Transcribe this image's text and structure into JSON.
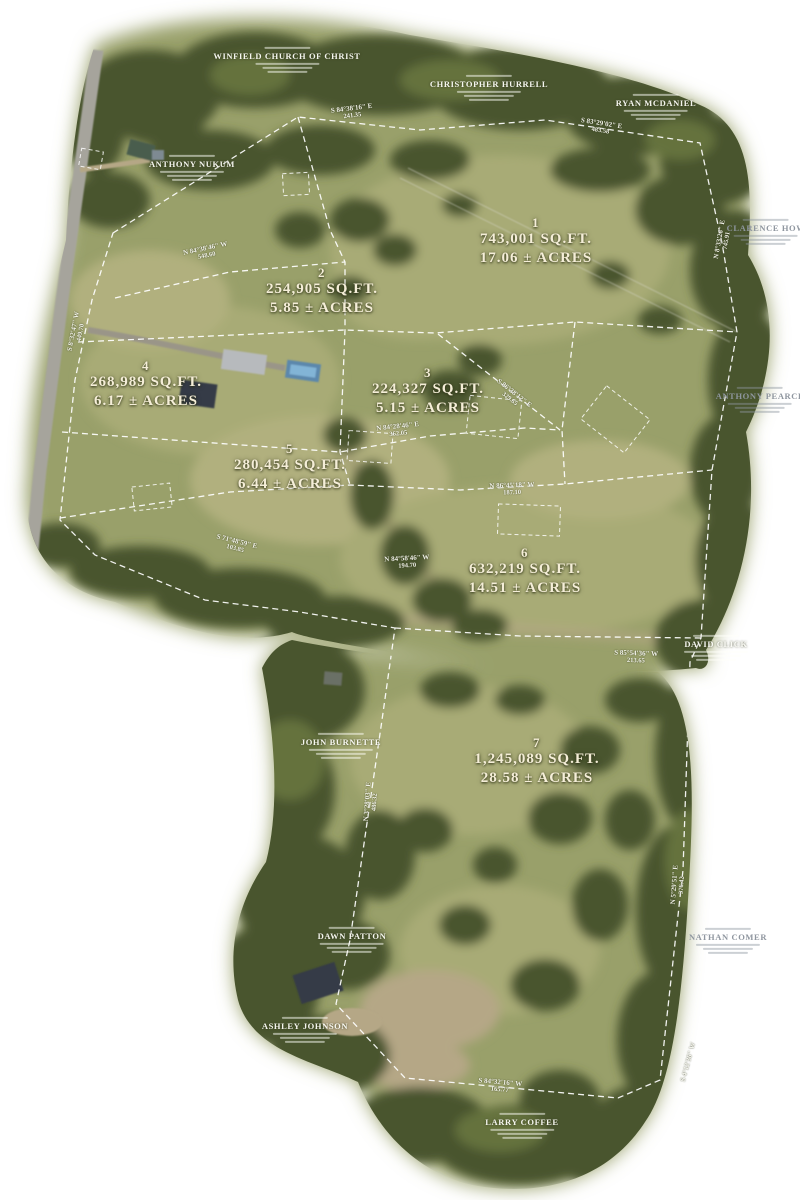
{
  "map": {
    "palette": {
      "field": "#99a06a",
      "field_light": "#a8ab76",
      "field_pale": "#b1b07e",
      "trees_dark": "#49552f",
      "trees": "#5a6739",
      "trees_light": "#6d7a42",
      "dirt": "#b5a786",
      "dirt_dark": "#8a7f63",
      "road": "#a6a49c",
      "parcel_line": "#ffffff",
      "roof_dark": "#343b47",
      "roof_light": "#b7babd",
      "pool": "#5b87ac",
      "pool_light": "#82b4d6",
      "label": "#f5eed8"
    },
    "lots": [
      {
        "id": "1",
        "sqft": "743,001 SQ.FT.",
        "acres": "17.06 ± ACRES",
        "x": 536,
        "y": 242
      },
      {
        "id": "2",
        "sqft": "254,905 SQ.FT.",
        "acres": "5.85 ± ACRES",
        "x": 322,
        "y": 292
      },
      {
        "id": "3",
        "sqft": "224,327 SQ.FT.",
        "acres": "5.15 ± ACRES",
        "x": 428,
        "y": 392
      },
      {
        "id": "4",
        "sqft": "268,989 SQ.FT.",
        "acres": "6.17 ± ACRES",
        "x": 146,
        "y": 385
      },
      {
        "id": "5",
        "sqft": "280,454 SQ.FT.",
        "acres": "6.44 ± ACRES",
        "x": 290,
        "y": 468
      },
      {
        "id": "6",
        "sqft": "632,219 SQ.FT.",
        "acres": "14.51 ± ACRES",
        "x": 525,
        "y": 572
      },
      {
        "id": "7",
        "sqft": "1,245,089 SQ.FT.",
        "acres": "28.58 ± ACRES",
        "x": 537,
        "y": 762
      }
    ],
    "owners": [
      {
        "name": "WINFIELD CHURCH OF CHRIST",
        "x": 287,
        "y": 60,
        "tone": "light"
      },
      {
        "name": "CHRISTOPHER HURRELL",
        "x": 489,
        "y": 88,
        "tone": "light"
      },
      {
        "name": "RYAN MCDANIEL",
        "x": 656,
        "y": 107,
        "tone": "light"
      },
      {
        "name": "ANTHONY NUKUM",
        "x": 192,
        "y": 168,
        "tone": "light"
      },
      {
        "name": "CLARENCE HOW",
        "x": 766,
        "y": 232,
        "tone": "gray"
      },
      {
        "name": "ANTHONY PEARCE",
        "x": 760,
        "y": 400,
        "tone": "gray"
      },
      {
        "name": "DAVID CLICK",
        "x": 716,
        "y": 648,
        "tone": "light"
      },
      {
        "name": "JOHN BURNETTE",
        "x": 341,
        "y": 746,
        "tone": "light"
      },
      {
        "name": "DAWN PATTON",
        "x": 352,
        "y": 940,
        "tone": "light"
      },
      {
        "name": "NATHAN COMER",
        "x": 728,
        "y": 941,
        "tone": "gray"
      },
      {
        "name": "ASHLEY JOHNSON",
        "x": 305,
        "y": 1030,
        "tone": "light"
      },
      {
        "name": "LARRY COFFEE",
        "x": 522,
        "y": 1126,
        "tone": "light"
      }
    ],
    "bearings": [
      {
        "b": "S 84°38'16\" E",
        "d": "241.35",
        "x": 352,
        "y": 112,
        "r": -7
      },
      {
        "b": "S 83°29'02\" E",
        "d": "483.58",
        "x": 601,
        "y": 127,
        "r": 9
      },
      {
        "b": "N 84°38'46\" W",
        "d": "548.60",
        "x": 206,
        "y": 252,
        "r": -12
      },
      {
        "b": "N 8°33'26\" E",
        "d": "745.91",
        "x": 723,
        "y": 240,
        "r": -80
      },
      {
        "b": "S 86°38'12\" E",
        "d": "329.65",
        "x": 512,
        "y": 396,
        "r": 38
      },
      {
        "b": "N 84°28'46\" E",
        "d": "362.05",
        "x": 398,
        "y": 430,
        "r": -6
      },
      {
        "b": "N 86°45'18\" W",
        "d": "187.10",
        "x": 512,
        "y": 489,
        "r": -2
      },
      {
        "b": "S 71°48'59\" E",
        "d": "103.85",
        "x": 236,
        "y": 545,
        "r": 14
      },
      {
        "b": "N 84°58'46\" W",
        "d": "194.70",
        "x": 407,
        "y": 562,
        "r": -3
      },
      {
        "b": "S 8°32'47\" W",
        "d": "449.70",
        "x": 77,
        "y": 332,
        "r": -79
      },
      {
        "b": "S 85°54'36\" W",
        "d": "213.65",
        "x": 636,
        "y": 657,
        "r": 2
      },
      {
        "b": "N 3°28'03\" E",
        "d": "486.32",
        "x": 371,
        "y": 802,
        "r": -86
      },
      {
        "b": "N 5°29'51\" E",
        "d": "376.42",
        "x": 678,
        "y": 885,
        "r": -86
      },
      {
        "b": "S 84°32'16\" W",
        "d": "165.77",
        "x": 500,
        "y": 1086,
        "r": 5
      },
      {
        "b": "S 4°12'36\" W",
        "d": "",
        "x": 688,
        "y": 1062,
        "r": -75
      }
    ]
  }
}
